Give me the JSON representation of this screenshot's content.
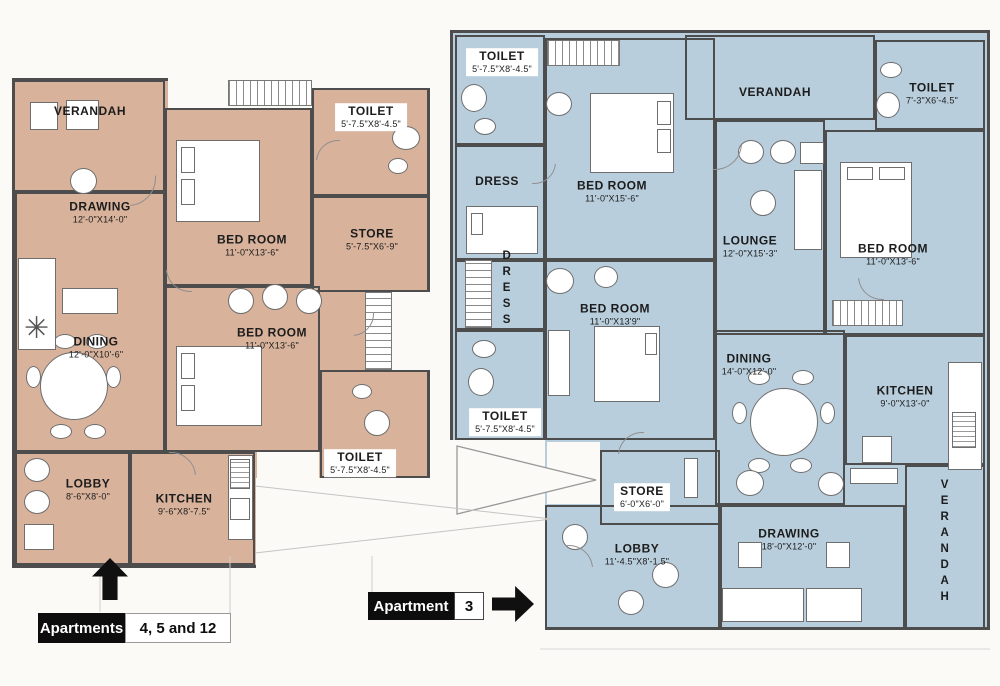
{
  "document": {
    "type": "architectural floor plan scan",
    "colors": {
      "left_plan_fill": "#d8b29b",
      "right_plan_fill": "#b9cedc",
      "wall": "#4d4d4d",
      "tag_background": "#0d0d0d"
    },
    "icons": {
      "left_entry_arrow": "arrow-up",
      "right_entry_arrow": "arrow-right",
      "plant": "plant-starburst"
    }
  },
  "plans": {
    "left": {
      "name": "Apartments 4, 5 and 12",
      "fill_color": "#d8b29b",
      "tag": {
        "label": "Apartments",
        "value": "4, 5 and 12"
      },
      "rooms": [
        {
          "id": "verandah",
          "label": "VERANDAH",
          "dims": ""
        },
        {
          "id": "drawing",
          "label": "DRAWING",
          "dims": "12'-0\"X14'-0\""
        },
        {
          "id": "bedroom-top",
          "label": "BED ROOM",
          "dims": "11'-0\"X13'-6\""
        },
        {
          "id": "toilet-top",
          "label": "TOILET",
          "dims": "5'-7.5\"X8'-4.5\""
        },
        {
          "id": "store",
          "label": "STORE",
          "dims": "5'-7.5\"X6'-9\""
        },
        {
          "id": "dining",
          "label": "DINING",
          "dims": "12'-0\"X10'-6\""
        },
        {
          "id": "bedroom-mid",
          "label": "BED ROOM",
          "dims": "11'-0\"X13'-6\""
        },
        {
          "id": "toilet-bottom",
          "label": "TOILET",
          "dims": "5'-7.5\"X8'-4.5\""
        },
        {
          "id": "lobby",
          "label": "LOBBY",
          "dims": "8'-6\"X8'-0\""
        },
        {
          "id": "kitchen",
          "label": "KITCHEN",
          "dims": "9'-6\"X8'-7.5\""
        }
      ]
    },
    "right": {
      "name": "Apartment 3",
      "fill_color": "#b9cedc",
      "tag": {
        "label": "Apartment",
        "value": "3"
      },
      "rooms": [
        {
          "id": "toilet-top-left",
          "label": "TOILET",
          "dims": "5'-7.5\"X8'-4.5\""
        },
        {
          "id": "dress-upper",
          "label": "DRESS",
          "dims": ""
        },
        {
          "id": "bedroom-top",
          "label": "BED ROOM",
          "dims": "11'-0\"X15'-6\""
        },
        {
          "id": "verandah-top",
          "label": "VERANDAH",
          "dims": ""
        },
        {
          "id": "toilet-top-right",
          "label": "TOILET",
          "dims": "7'-3\"X6'-4.5\""
        },
        {
          "id": "lounge",
          "label": "LOUNGE",
          "dims": "12'-0\"X15'-3\""
        },
        {
          "id": "bedroom-right",
          "label": "BED ROOM",
          "dims": "11'-0\"X13'-6\""
        },
        {
          "id": "dress-mid",
          "label": "DRESS",
          "dims": ""
        },
        {
          "id": "bedroom-mid",
          "label": "BED ROOM",
          "dims": "11'-0\"X13'9\""
        },
        {
          "id": "toilet-mid-left",
          "label": "TOILET",
          "dims": "5'-7.5\"X8'-4.5\""
        },
        {
          "id": "dining",
          "label": "DINING",
          "dims": "14'-0\"X12'-0\""
        },
        {
          "id": "kitchen",
          "label": "KITCHEN",
          "dims": "9'-0\"X13'-0\""
        },
        {
          "id": "store",
          "label": "STORE",
          "dims": "6'-0\"X6'-0\""
        },
        {
          "id": "lobby",
          "label": "LOBBY",
          "dims": "11'-4.5\"X8'-1.5\""
        },
        {
          "id": "drawing",
          "label": "DRAWING",
          "dims": "18'-0\"X12'-0\""
        },
        {
          "id": "verandah-right",
          "label": "VERANDAH",
          "dims": ""
        }
      ]
    }
  }
}
